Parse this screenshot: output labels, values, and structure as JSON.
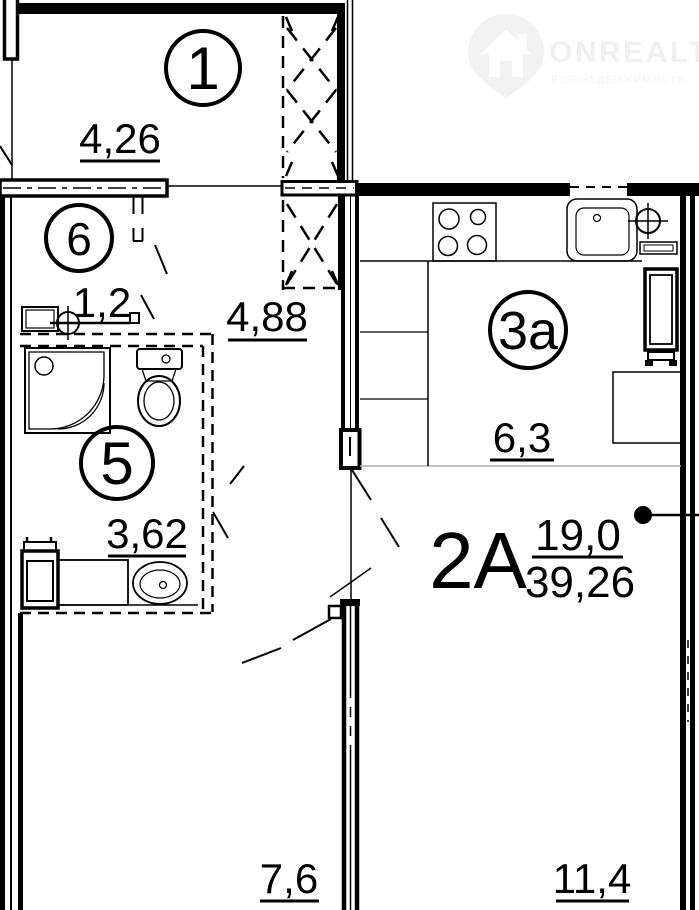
{
  "watermark": {
    "brand": "ONREALT",
    "tagline": "ВСЯ НЕДВИЖИМОСТЬ",
    "color": "#f0f0f0",
    "icon": "house-pin-icon"
  },
  "plan": {
    "apartment": {
      "type_label": "2А",
      "living_area": "19,0",
      "total_area": "39,26"
    },
    "rooms": [
      {
        "number": "1",
        "area": "4,26"
      },
      {
        "number": "6",
        "area": "1,2"
      },
      {
        "number": "5",
        "area": "3,62"
      },
      {
        "number": "3а",
        "area": "6,3"
      }
    ],
    "hall": {
      "area": "4,88"
    },
    "lower_rooms": [
      {
        "area": "7,6"
      },
      {
        "area": "11,4"
      }
    ],
    "colors": {
      "line": "#000000",
      "zone_divider": "#adadad",
      "background": "#ffffff"
    }
  }
}
